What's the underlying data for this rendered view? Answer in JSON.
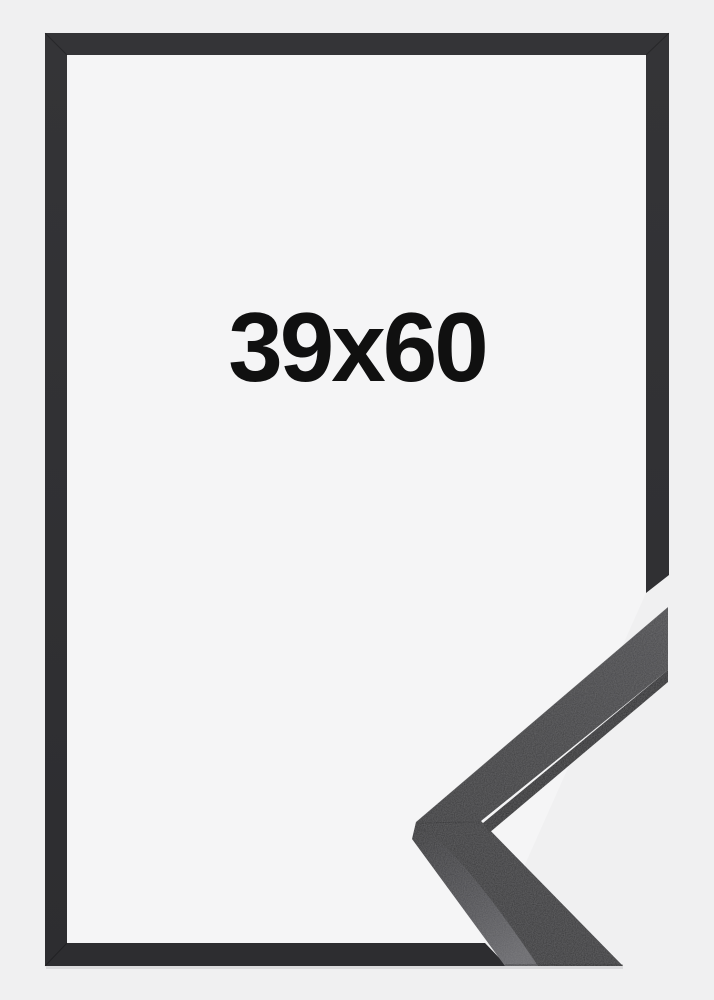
{
  "product_photo": {
    "size_label": "39x60",
    "alt": "Black picture frame shown with a mitered corner moulding sample",
    "colors": {
      "page_background": "#f0f0f1",
      "frame_opening": "#f5f5f6",
      "frame_moulding": "#323234",
      "label_text": "#101010",
      "sample_face_light": "#48484b",
      "sample_face_dark": "#313133",
      "sample_side_light": "#66666a",
      "sample_side_dark": "#28282a"
    }
  }
}
